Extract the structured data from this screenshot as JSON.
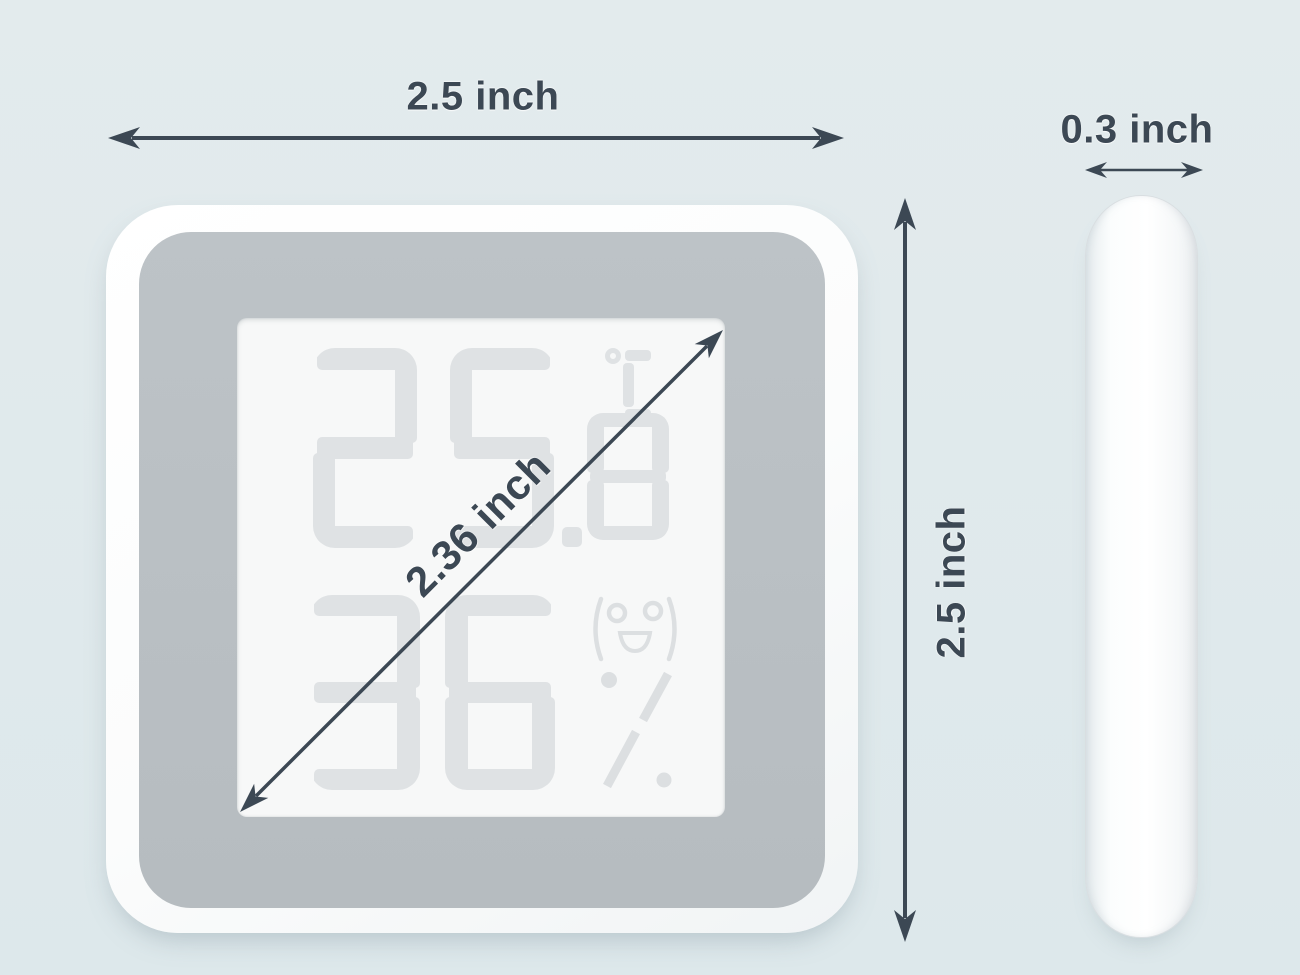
{
  "scene": {
    "background_color": "#dde8eb",
    "annotation_color": "#3c4854"
  },
  "annotations": {
    "width_label": "2.5 inch",
    "height_label": "2.5 inch",
    "diagonal_label": "2.36 inch",
    "thickness_label": "0.3 inch"
  },
  "device": {
    "front": {
      "display": {
        "temperature": "25.8",
        "temperature_unit": "°C",
        "humidity": "36",
        "humidity_unit": "%",
        "mood_icon": "smiley-face"
      },
      "frame_color": "#fbfcfc",
      "bezel_color": "#b9bfc3",
      "lcd_color": "#f7f8f8",
      "segment_color": "#dfe2e4"
    },
    "side": {
      "body_color": "#fdfefe"
    }
  }
}
